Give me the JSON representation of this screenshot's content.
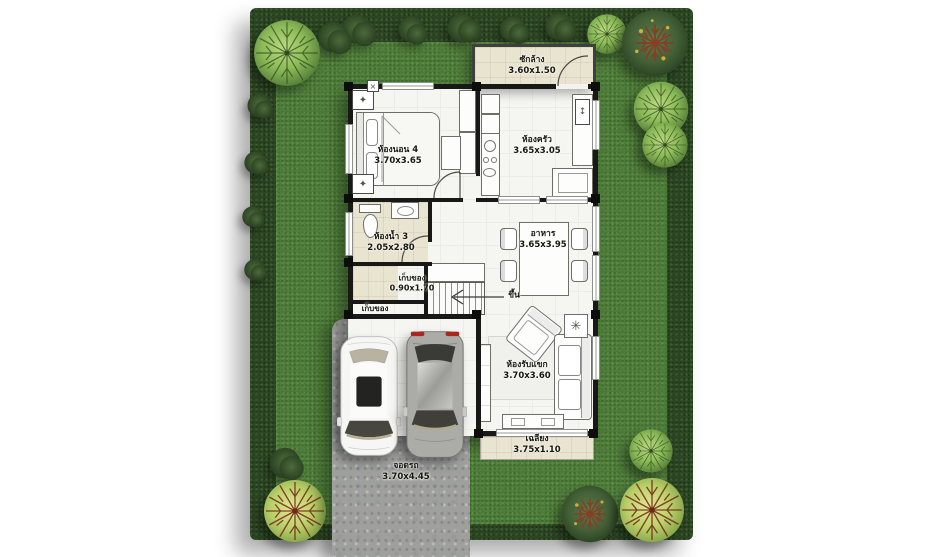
{
  "scene": {
    "type": "house-floor-plan-top-view"
  },
  "rooms": {
    "laundry": {
      "label": "ซักล้าง",
      "dims": "3.60x1.50"
    },
    "bedroom4": {
      "label": "ห้องนอน 4",
      "dims": "3.70x3.65"
    },
    "kitchen": {
      "label": "ห้องครัว",
      "dims": "3.65x3.05"
    },
    "bathroom3": {
      "label": "ห้องน้ำ 3",
      "dims": "2.05x2.80"
    },
    "dining": {
      "label": "อาหาร",
      "dims": "3.65x3.95"
    },
    "storage": {
      "label": "เก็บของ",
      "dims": "0.90x1.70"
    },
    "storage_under_stairs": {
      "label": "เก็บของ"
    },
    "stairs": {
      "label": "ขึ้น"
    },
    "living": {
      "label": "ห้องรับแขก",
      "dims": "3.70x3.60"
    },
    "porch": {
      "label": "เฉลียง",
      "dims": "3.75x1.10"
    },
    "parking": {
      "label": "จอดรถ",
      "dims": "3.70x4.45"
    }
  },
  "icons": {
    "lamp": "✦",
    "vent": "×",
    "updown": "↕",
    "plant": "✳"
  },
  "colors": {
    "grass": "#4e7c39",
    "hedge": "#2c4523",
    "floor": "#f5f5f2",
    "tile": "#e9e4d0",
    "wall": "#181816",
    "driveway": "#9fa09e",
    "tree_light": "#8cba58",
    "tree_dark": "#435f36",
    "tree_yellow": "#bcd06a",
    "branch_red": "#8a3a22",
    "white_car": "#f6f6f4",
    "gray_car": "#ababa8"
  }
}
